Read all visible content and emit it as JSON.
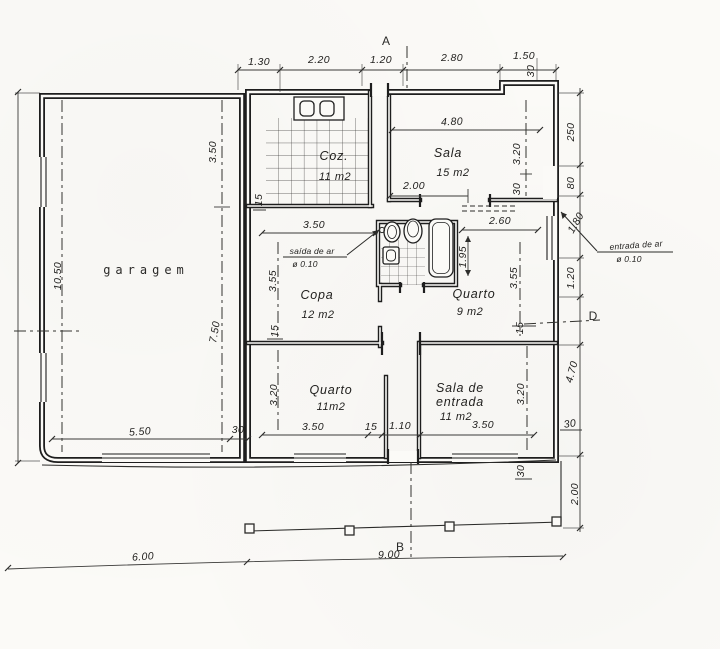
{
  "paper": {
    "bg": "#fbfaf7",
    "ink": "#1e1e1e",
    "dim_ink": "#3a3a38"
  },
  "markers": {
    "a": "A",
    "b": "B",
    "d": "D"
  },
  "rooms": {
    "garage": {
      "name": "garagem"
    },
    "kitchen": {
      "name": "Coz.",
      "area": "11 m2"
    },
    "living": {
      "name": "Sala",
      "area": "15 m2"
    },
    "pantry": {
      "name": "Copa",
      "area": "12 m2"
    },
    "bedroom_small": {
      "name": "Quarto",
      "area": "9 m2"
    },
    "bedroom": {
      "name": "Quarto",
      "area": "11m2"
    },
    "entry": {
      "name1": "Sala de",
      "name2": "entrada",
      "area": "11 m2"
    }
  },
  "annotations": {
    "air_outlet": "saída de ar",
    "air_outlet_dia": "ø 0.10",
    "air_inlet": "entrada de ar",
    "air_inlet_dia": "ø 0.10"
  },
  "dims": {
    "top": [
      "1.30",
      "2.20",
      "1.20",
      "2.80",
      "1.50"
    ],
    "top_step": "30",
    "right": [
      "250",
      "80",
      "1.80",
      "1.20",
      "4.70",
      "30",
      "2.00"
    ],
    "right_wall_thk": "30",
    "left_total": "10.50",
    "bottom": [
      "6.00",
      "9.00"
    ],
    "garage": [
      "3.50",
      "7.50",
      "5.50",
      "30"
    ],
    "living": [
      "4.80",
      "2.00",
      "3.20",
      "30"
    ],
    "pantry": [
      "3.50",
      "3.55",
      "15",
      "15"
    ],
    "bedroom_small": [
      "2.60",
      "1.95",
      "3.55",
      "15"
    ],
    "bedroom": [
      "3.50",
      "3.20"
    ],
    "corridor": [
      "15",
      "1.10"
    ],
    "entry": [
      "3.50",
      "3.20"
    ]
  }
}
